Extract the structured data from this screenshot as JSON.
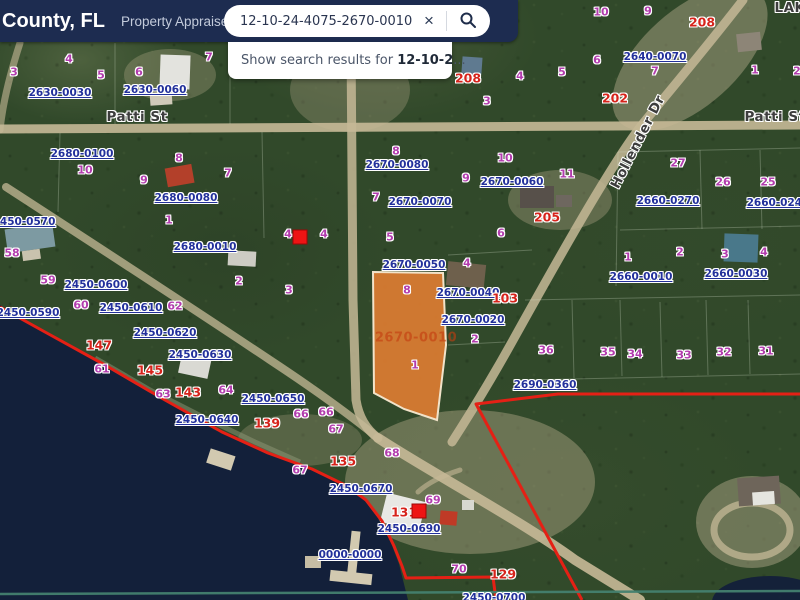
{
  "header": {
    "title": "County, FL",
    "subtitle": "Property Appraiser",
    "search": {
      "value": "12-10-24-4075-2670-0010",
      "clear_label": "×"
    },
    "suggestion": {
      "prefix": "Show search results for ",
      "query": "12-10-2",
      "suffix": "..."
    }
  },
  "colors": {
    "header_bg": "#1d2c50",
    "parcel_label": "#22309b",
    "lot_number": "#b23cae",
    "address_red": "#d6231b",
    "highlight_fill": "#db7c31",
    "boundary_red": "#e52015"
  },
  "map": {
    "highlight": {
      "parcel_id": "2670-0010"
    },
    "streets": [
      {
        "t": "Patti St",
        "x": 137,
        "y": 117,
        "r": 0
      },
      {
        "t": "Patti St",
        "x": 775,
        "y": 117,
        "r": 0
      },
      {
        "t": "Hollender Dr",
        "x": 638,
        "y": 142,
        "r": -63
      },
      {
        "t": "LAK",
        "x": 790,
        "y": 8,
        "r": 0
      }
    ],
    "parcel_ids": [
      {
        "t": "2630-0030",
        "x": 60,
        "y": 93
      },
      {
        "t": "2630-0060",
        "x": 155,
        "y": 90
      },
      {
        "t": "2680-0100",
        "x": 82,
        "y": 154
      },
      {
        "t": "2680-0080",
        "x": 186,
        "y": 198
      },
      {
        "t": "2680-0010",
        "x": 205,
        "y": 247
      },
      {
        "t": "2450-0570",
        "x": 24,
        "y": 222
      },
      {
        "t": "2450-0590",
        "x": 28,
        "y": 313
      },
      {
        "t": "2450-0600",
        "x": 96,
        "y": 285
      },
      {
        "t": "2450-0610",
        "x": 131,
        "y": 308
      },
      {
        "t": "2450-0620",
        "x": 165,
        "y": 333
      },
      {
        "t": "2450-0630",
        "x": 200,
        "y": 355
      },
      {
        "t": "2450-0640",
        "x": 207,
        "y": 420
      },
      {
        "t": "2450-0650",
        "x": 273,
        "y": 399
      },
      {
        "t": "2450-0670",
        "x": 361,
        "y": 489
      },
      {
        "t": "2450-0690",
        "x": 409,
        "y": 529
      },
      {
        "t": "0000-0000",
        "x": 350,
        "y": 555
      },
      {
        "t": "2450-0700",
        "x": 494,
        "y": 598
      },
      {
        "t": "2670-0080",
        "x": 397,
        "y": 165
      },
      {
        "t": "2670-0060",
        "x": 512,
        "y": 182
      },
      {
        "t": "2670-0070",
        "x": 420,
        "y": 202
      },
      {
        "t": "2670-0050",
        "x": 414,
        "y": 265
      },
      {
        "t": "2670-0040",
        "x": 468,
        "y": 293
      },
      {
        "t": "2670-0020",
        "x": 473,
        "y": 320
      },
      {
        "t": "2640-0070",
        "x": 655,
        "y": 57
      },
      {
        "t": "2660-0270",
        "x": 668,
        "y": 201
      },
      {
        "t": "2660-0240",
        "x": 778,
        "y": 203
      },
      {
        "t": "2660-0010",
        "x": 641,
        "y": 277
      },
      {
        "t": "2660-0030",
        "x": 736,
        "y": 274
      },
      {
        "t": "2690-0360",
        "x": 545,
        "y": 385
      }
    ],
    "lot_numbers": [
      {
        "t": "3",
        "x": 14,
        "y": 72
      },
      {
        "t": "4",
        "x": 69,
        "y": 59
      },
      {
        "t": "5",
        "x": 101,
        "y": 75
      },
      {
        "t": "6",
        "x": 139,
        "y": 72
      },
      {
        "t": "7",
        "x": 209,
        "y": 57
      },
      {
        "t": "8",
        "x": 179,
        "y": 158
      },
      {
        "t": "9",
        "x": 144,
        "y": 180
      },
      {
        "t": "10",
        "x": 85,
        "y": 170
      },
      {
        "t": "7",
        "x": 228,
        "y": 173
      },
      {
        "t": "1",
        "x": 169,
        "y": 220
      },
      {
        "t": "58",
        "x": 12,
        "y": 253
      },
      {
        "t": "59",
        "x": 48,
        "y": 280
      },
      {
        "t": "60",
        "x": 81,
        "y": 305
      },
      {
        "t": "62",
        "x": 175,
        "y": 306
      },
      {
        "t": "2",
        "x": 239,
        "y": 281
      },
      {
        "t": "61",
        "x": 102,
        "y": 369
      },
      {
        "t": "63",
        "x": 163,
        "y": 394
      },
      {
        "t": "64",
        "x": 226,
        "y": 390
      },
      {
        "t": "66",
        "x": 301,
        "y": 414
      },
      {
        "t": "66",
        "x": 326,
        "y": 412
      },
      {
        "t": "67",
        "x": 336,
        "y": 429
      },
      {
        "t": "67",
        "x": 300,
        "y": 470
      },
      {
        "t": "68",
        "x": 392,
        "y": 453
      },
      {
        "t": "69",
        "x": 433,
        "y": 500
      },
      {
        "t": "70",
        "x": 459,
        "y": 569
      },
      {
        "t": "4",
        "x": 288,
        "y": 234
      },
      {
        "t": "4",
        "x": 324,
        "y": 234
      },
      {
        "t": "3",
        "x": 289,
        "y": 290
      },
      {
        "t": "5",
        "x": 390,
        "y": 237
      },
      {
        "t": "2",
        "x": 475,
        "y": 339
      },
      {
        "t": "1",
        "x": 415,
        "y": 365
      },
      {
        "t": "8",
        "x": 407,
        "y": 290
      },
      {
        "t": "4",
        "x": 467,
        "y": 263
      },
      {
        "t": "3",
        "x": 487,
        "y": 101
      },
      {
        "t": "4",
        "x": 520,
        "y": 76
      },
      {
        "t": "5",
        "x": 562,
        "y": 72
      },
      {
        "t": "6",
        "x": 501,
        "y": 233
      },
      {
        "t": "7",
        "x": 376,
        "y": 197
      },
      {
        "t": "8",
        "x": 396,
        "y": 151
      },
      {
        "t": "9",
        "x": 466,
        "y": 178
      },
      {
        "t": "10",
        "x": 505,
        "y": 158
      },
      {
        "t": "11",
        "x": 567,
        "y": 174
      },
      {
        "t": "6",
        "x": 597,
        "y": 60
      },
      {
        "t": "7",
        "x": 655,
        "y": 71
      },
      {
        "t": "10",
        "x": 601,
        "y": 12
      },
      {
        "t": "9",
        "x": 648,
        "y": 11
      },
      {
        "t": "1",
        "x": 755,
        "y": 70
      },
      {
        "t": "2",
        "x": 797,
        "y": 71
      },
      {
        "t": "27",
        "x": 678,
        "y": 163
      },
      {
        "t": "26",
        "x": 723,
        "y": 182
      },
      {
        "t": "25",
        "x": 768,
        "y": 182
      },
      {
        "t": "1",
        "x": 628,
        "y": 257
      },
      {
        "t": "2",
        "x": 680,
        "y": 252
      },
      {
        "t": "3",
        "x": 725,
        "y": 254
      },
      {
        "t": "4",
        "x": 764,
        "y": 252
      },
      {
        "t": "36",
        "x": 546,
        "y": 350
      },
      {
        "t": "35",
        "x": 608,
        "y": 352
      },
      {
        "t": "34",
        "x": 635,
        "y": 354
      },
      {
        "t": "33",
        "x": 684,
        "y": 355
      },
      {
        "t": "32",
        "x": 724,
        "y": 352
      },
      {
        "t": "31",
        "x": 766,
        "y": 351
      }
    ],
    "addresses": [
      {
        "t": "208",
        "x": 468,
        "y": 78
      },
      {
        "t": "208",
        "x": 702,
        "y": 22
      },
      {
        "t": "202",
        "x": 615,
        "y": 98
      },
      {
        "t": "205",
        "x": 547,
        "y": 217
      },
      {
        "t": "103",
        "x": 505,
        "y": 298
      },
      {
        "t": "147",
        "x": 99,
        "y": 345
      },
      {
        "t": "145",
        "x": 150,
        "y": 370
      },
      {
        "t": "143",
        "x": 188,
        "y": 392
      },
      {
        "t": "139",
        "x": 267,
        "y": 423
      },
      {
        "t": "135",
        "x": 343,
        "y": 461
      },
      {
        "t": "131",
        "x": 404,
        "y": 512
      },
      {
        "t": "129",
        "x": 503,
        "y": 574
      }
    ],
    "markers": [
      {
        "x": 300,
        "y": 237
      },
      {
        "x": 419,
        "y": 511
      }
    ]
  }
}
